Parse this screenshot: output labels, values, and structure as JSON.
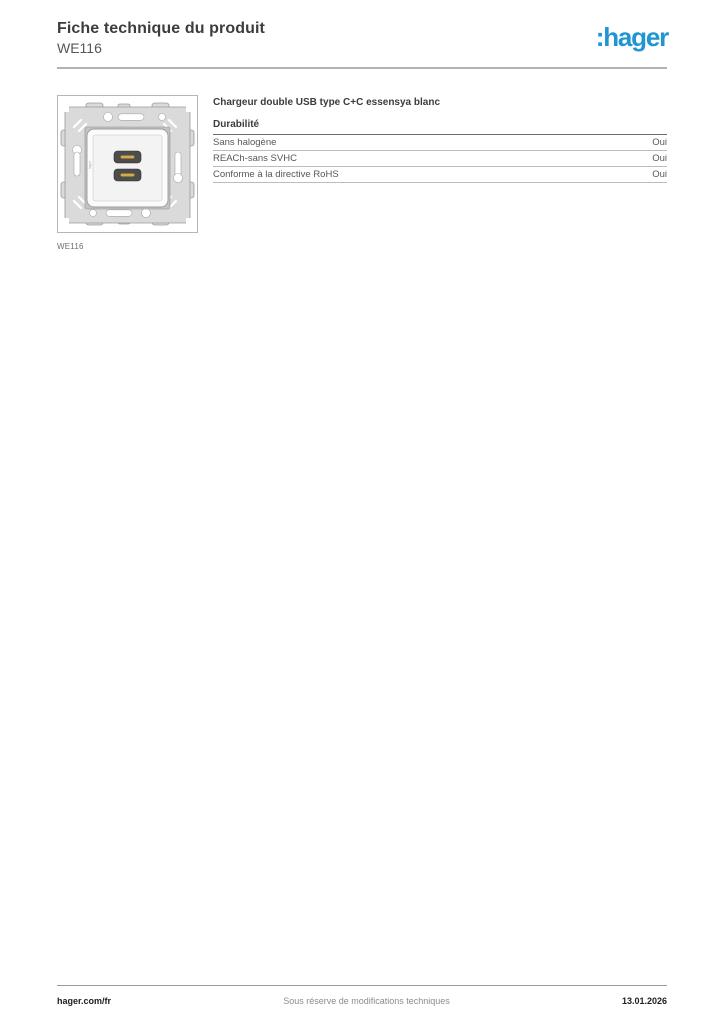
{
  "header": {
    "title": "Fiche technique du produit",
    "product_ref": "WE116",
    "logo_text": ":hager",
    "logo_color": "#2095d3"
  },
  "product": {
    "name": "Chargeur double USB type C+C essensya blanc",
    "image_caption": "WE116"
  },
  "sections": [
    {
      "heading": "Durabilité",
      "rows": [
        {
          "label": "Sans halogène",
          "value": "Oui"
        },
        {
          "label": "REACh-sans SVHC",
          "value": "Oui"
        },
        {
          "label": "Conforme à la directive RoHS",
          "value": "Oui"
        }
      ]
    }
  ],
  "footer": {
    "left": "hager.com/fr",
    "center": "Sous réserve de modifications techniques",
    "right": "13.01.2026"
  }
}
